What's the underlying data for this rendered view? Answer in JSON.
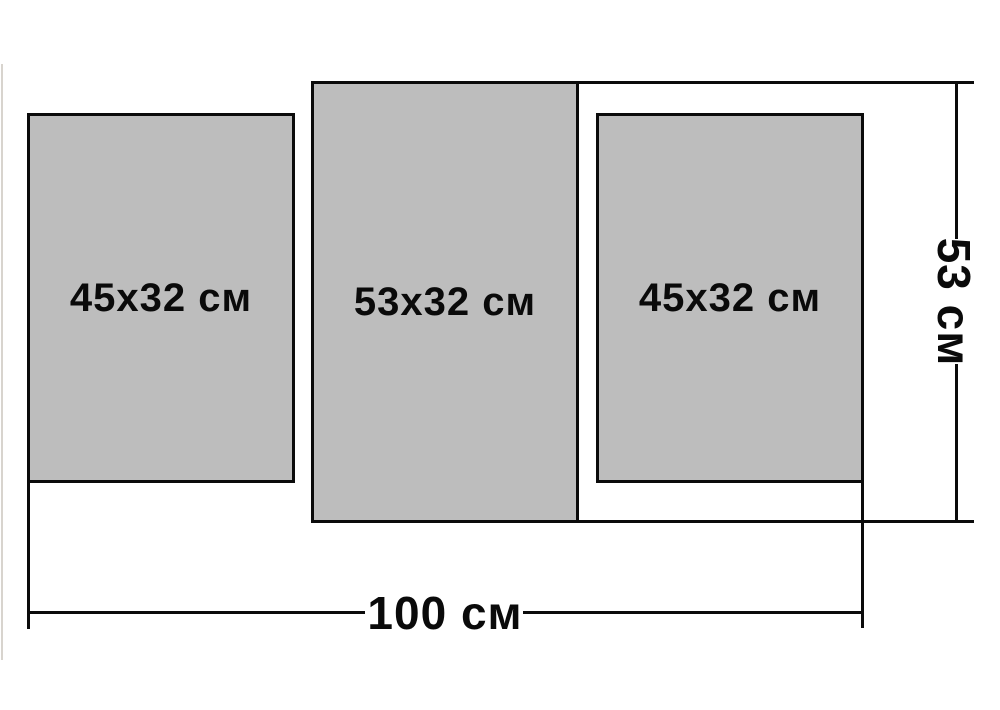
{
  "diagram": {
    "type": "product-size-diagram",
    "panels": [
      {
        "position": "left",
        "label": "45x32 см"
      },
      {
        "position": "middle",
        "label": "53x32 см"
      },
      {
        "position": "right",
        "label": "45x32 см"
      }
    ],
    "overall_dimensions": {
      "height_label": "53 см",
      "width_label": "100 см"
    },
    "colors": {
      "background": "#ffffff",
      "panel_fill": "#bdbdbd",
      "panel_border": "#0b0b0b",
      "dimension_line": "#0b0b0b",
      "text": "#0a0a0a",
      "photo_edge": "#d8d4ce"
    }
  }
}
